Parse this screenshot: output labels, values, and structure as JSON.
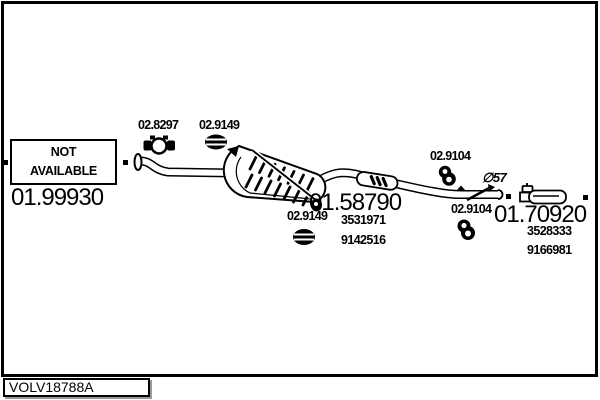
{
  "frame": {
    "code_box": "VOLV18788A"
  },
  "not_available": {
    "line1": "NOT",
    "line2": "AVAILABLE"
  },
  "parts": {
    "front_pipe": {
      "number": "01.99930"
    },
    "mid_silencer": {
      "number": "01.58790",
      "oe_refs": [
        "3531971",
        "9142516"
      ]
    },
    "rear_silencer": {
      "number": "01.70920",
      "oe_refs": [
        "3528333",
        "9166981"
      ]
    }
  },
  "fittings": {
    "clamp": "02.8297",
    "gasket_front": "02.9149",
    "gasket_rear": "02.9149",
    "hanger_mid": "02.9104",
    "hanger_rear": "02.9104"
  },
  "annotations": {
    "pipe_diameter": "∅57"
  },
  "colors": {
    "line": "#000000",
    "shadow": "#9a9a9a",
    "background": "#ffffff"
  }
}
